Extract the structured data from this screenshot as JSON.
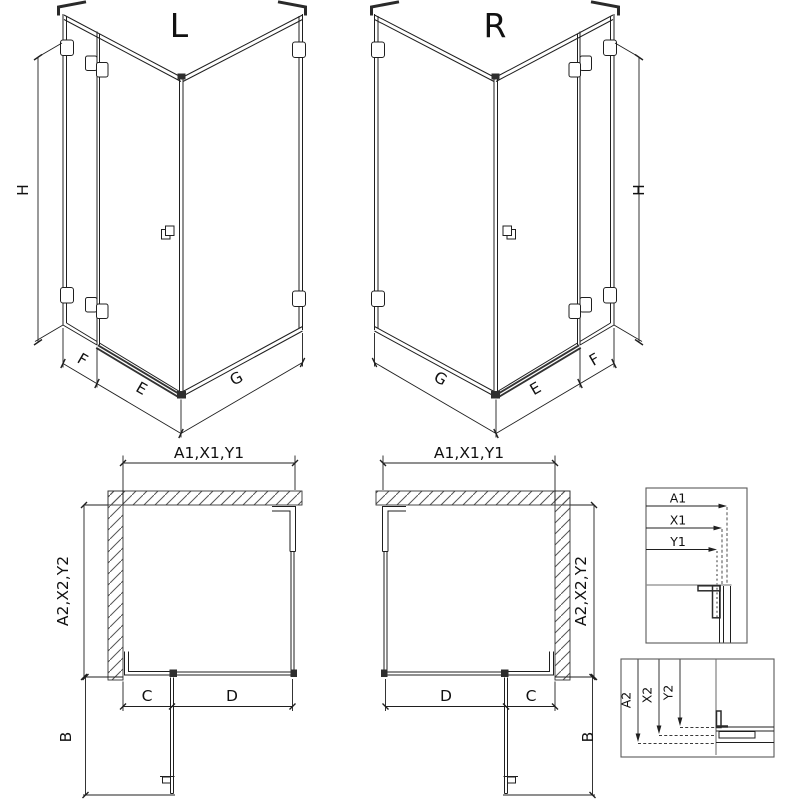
{
  "iso_left": {
    "view_label": "L",
    "dim_height": "H",
    "dim_f": "F",
    "dim_e": "E",
    "dim_g": "G"
  },
  "iso_right": {
    "view_label": "R",
    "dim_height": "H",
    "dim_f": "F",
    "dim_e": "E",
    "dim_g": "G"
  },
  "plan_left": {
    "dim_top": "A1,X1,Y1",
    "dim_side": "A2,X2,Y2",
    "dim_c": "C",
    "dim_d": "D",
    "dim_b": "B"
  },
  "plan_right": {
    "dim_top": "A1,X1,Y1",
    "dim_side": "A2,X2,Y2",
    "dim_c": "C",
    "dim_d": "D",
    "dim_b": "B"
  },
  "detail_top": {
    "d1": "A1",
    "d2": "X1",
    "d3": "Y1"
  },
  "detail_bottom": {
    "d1": "A2",
    "d2": "X2",
    "d3": "Y2"
  },
  "colors": {
    "line": "#1f1f1f",
    "gray": "#8a8a8a",
    "dark_fill": "#2e2e2e",
    "background": "#ffffff"
  }
}
